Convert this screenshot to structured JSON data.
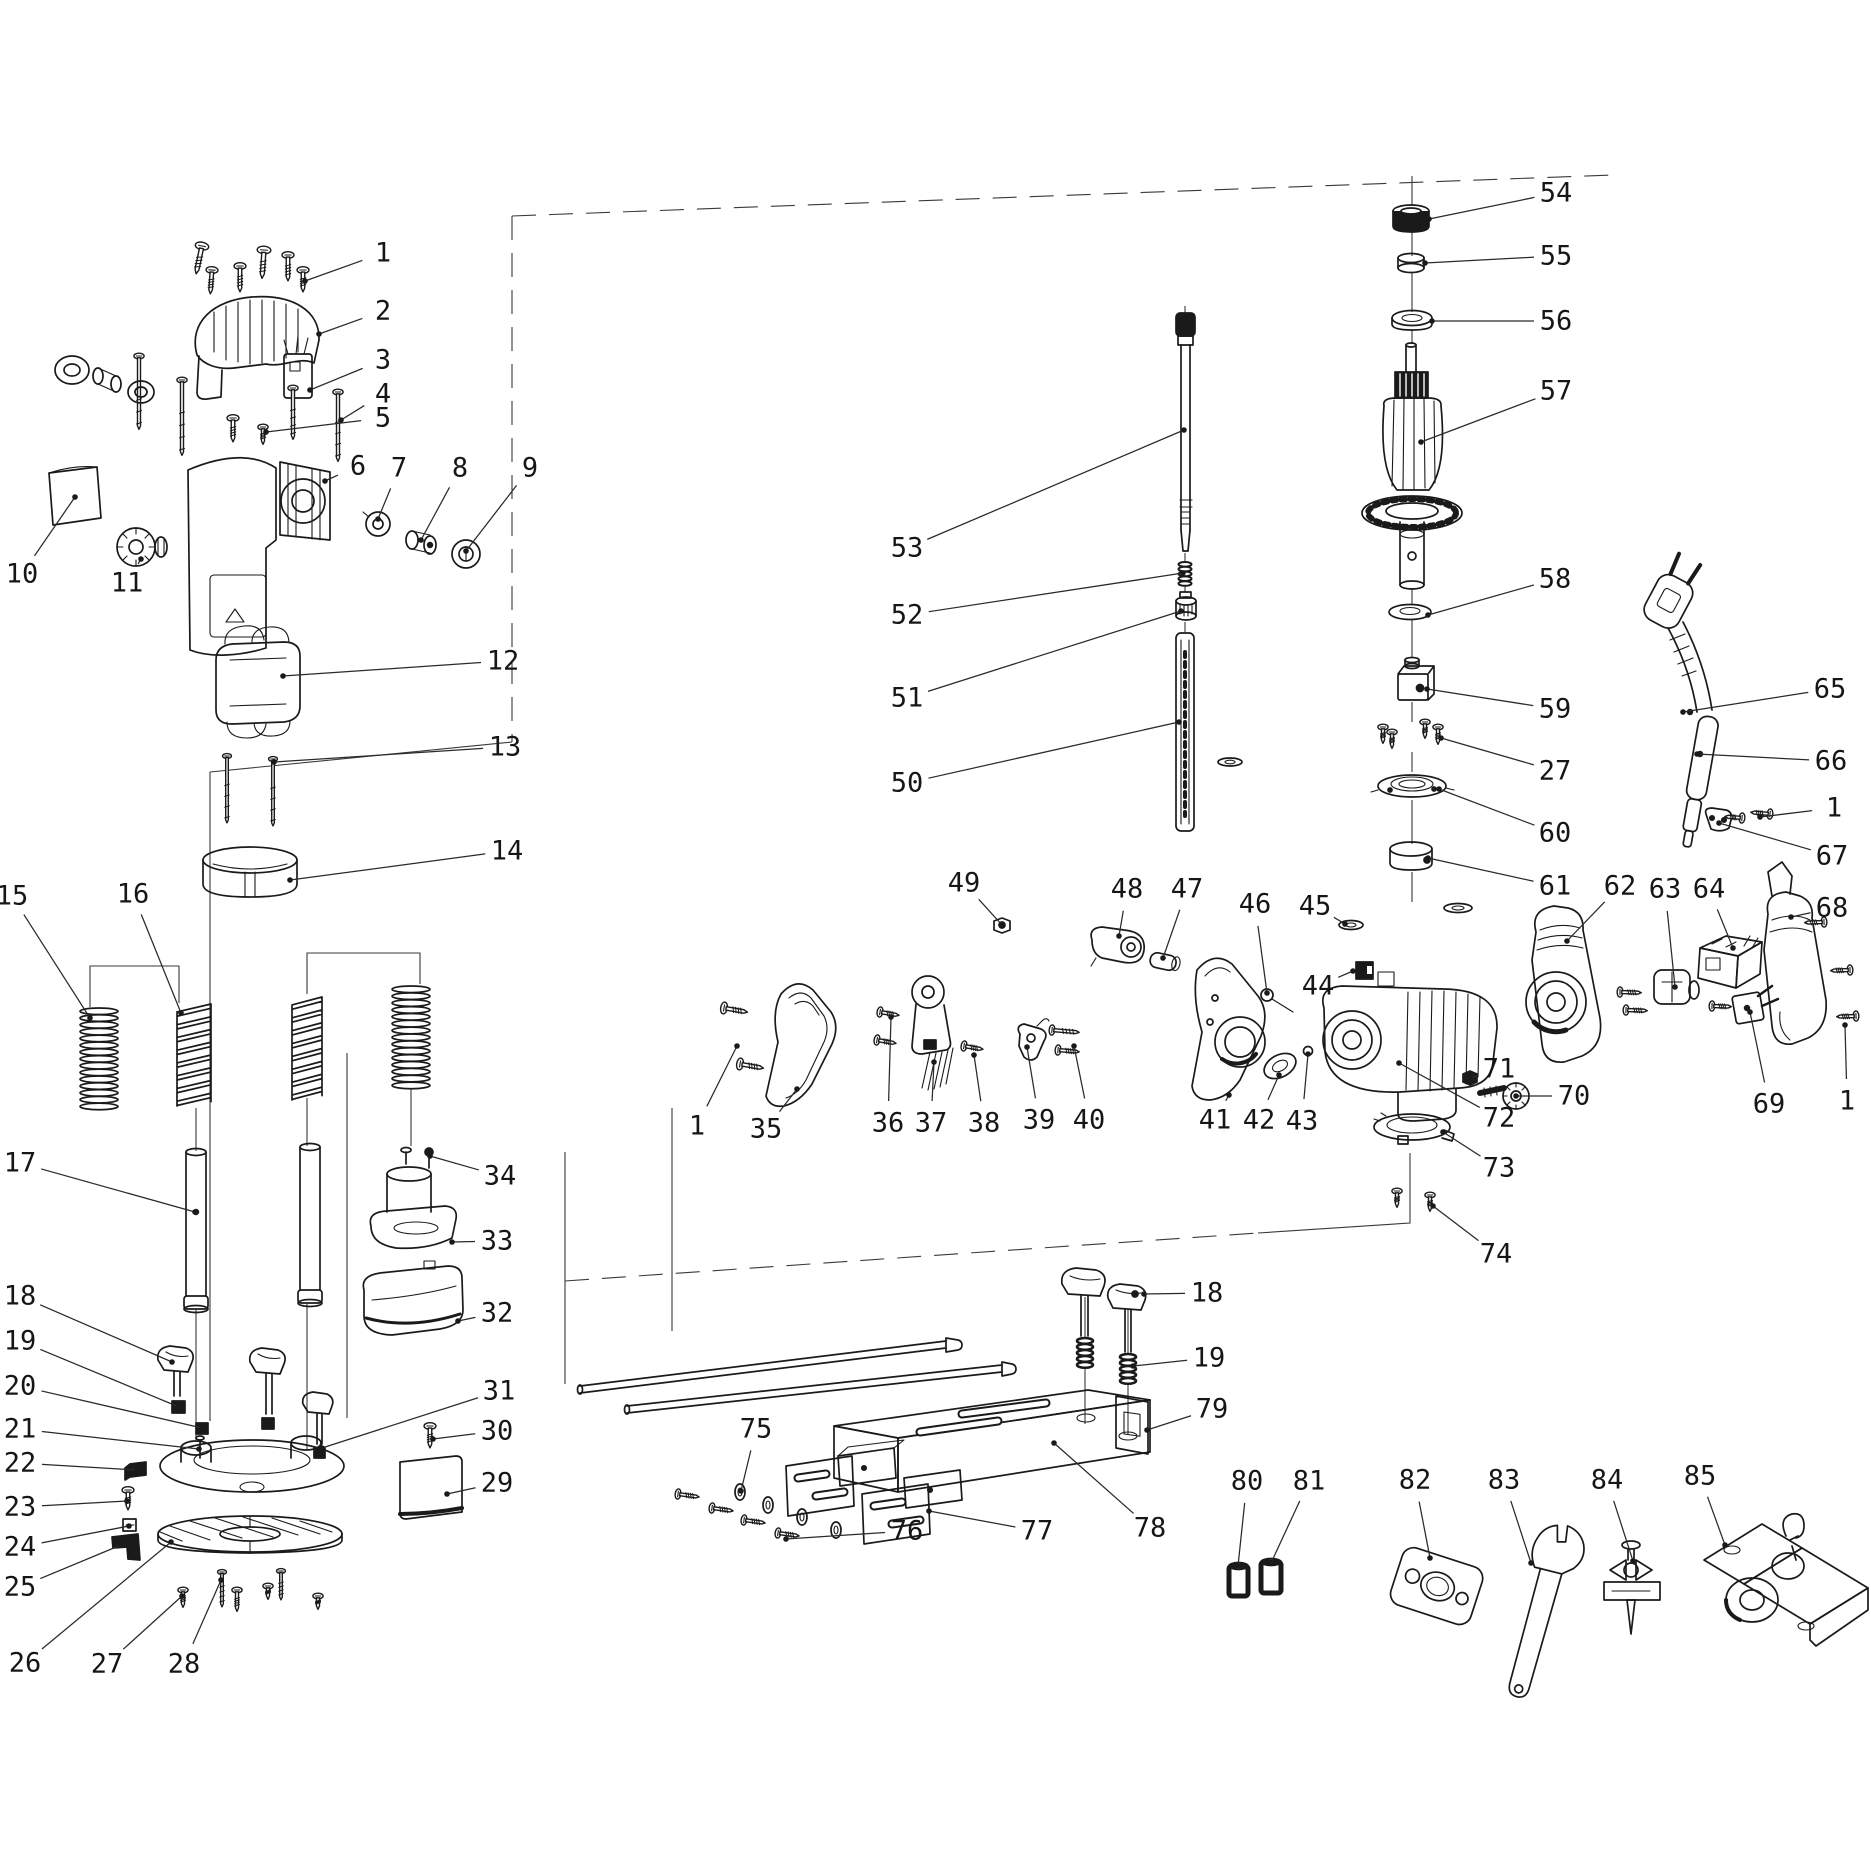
{
  "figure": {
    "kind": "exploded-parts-diagram",
    "background": "#ffffff",
    "ink_color": "#1a1a1a",
    "canvas": {
      "width": 1871,
      "height": 1872
    },
    "part_numbers_visible": [
      "1",
      "2",
      "3",
      "4",
      "5",
      "6",
      "7",
      "8",
      "9",
      "10",
      "11",
      "12",
      "13",
      "14",
      "15",
      "16",
      "17",
      "18",
      "19",
      "20",
      "21",
      "22",
      "23",
      "24",
      "25",
      "26",
      "27",
      "28",
      "29",
      "30",
      "31",
      "32",
      "33",
      "34",
      "35",
      "36",
      "37",
      "38",
      "39",
      "40",
      "41",
      "42",
      "43",
      "44",
      "45",
      "46",
      "47",
      "48",
      "49",
      "50",
      "51",
      "52",
      "53",
      "54",
      "55",
      "56",
      "57",
      "58",
      "59",
      "60",
      "61",
      "62",
      "63",
      "64",
      "65",
      "66",
      "67",
      "68",
      "69",
      "70",
      "71",
      "72",
      "73",
      "74",
      "75",
      "76",
      "77",
      "78",
      "79",
      "80",
      "81",
      "82",
      "83",
      "84",
      "85"
    ]
  },
  "diagram": {
    "leader_dot_radius": 2.8,
    "labels": [
      {
        "n": "1",
        "x": 383,
        "y": 253,
        "tx": 305,
        "ty": 281
      },
      {
        "n": "2",
        "x": 383,
        "y": 311,
        "tx": 319,
        "ty": 334
      },
      {
        "n": "3",
        "x": 383,
        "y": 360,
        "tx": 310,
        "ty": 390
      },
      {
        "n": "4",
        "x": 383,
        "y": 394,
        "tx": 341,
        "ty": 420
      },
      {
        "n": "5",
        "x": 383,
        "y": 418,
        "tx": 266,
        "ty": 432
      },
      {
        "n": "6",
        "x": 358,
        "y": 466,
        "tx": 325,
        "ty": 481
      },
      {
        "n": "7",
        "x": 399,
        "y": 468,
        "tx": 378,
        "ty": 519
      },
      {
        "n": "8",
        "x": 460,
        "y": 468,
        "tx": 421,
        "ty": 540
      },
      {
        "n": "9",
        "x": 530,
        "y": 468,
        "tx": 466,
        "ty": 551
      },
      {
        "n": "10",
        "x": 22,
        "y": 574,
        "tx": 75,
        "ty": 497
      },
      {
        "n": "11",
        "x": 127,
        "y": 583,
        "tx": 141,
        "ty": 559
      },
      {
        "n": "12",
        "x": 503,
        "y": 661,
        "tx": 283,
        "ty": 676
      },
      {
        "n": "13",
        "x": 505,
        "y": 747,
        "tx": 274,
        "ty": 762
      },
      {
        "n": "14",
        "x": 507,
        "y": 851,
        "tx": 290,
        "ty": 880
      },
      {
        "n": "15",
        "x": 12,
        "y": 896,
        "tx": 90,
        "ty": 1018
      },
      {
        "n": "16",
        "x": 133,
        "y": 894,
        "tx": 181,
        "ty": 1013
      },
      {
        "n": "17",
        "x": 20,
        "y": 1163,
        "tx": 195,
        "ty": 1212
      },
      {
        "n": "18",
        "x": 20,
        "y": 1296,
        "tx": 172,
        "ty": 1362
      },
      {
        "n": "19",
        "x": 20,
        "y": 1341,
        "tx": 179,
        "ty": 1407
      },
      {
        "n": "20",
        "x": 20,
        "y": 1386,
        "tx": 202,
        "ty": 1428
      },
      {
        "n": "21",
        "x": 20,
        "y": 1429,
        "tx": 199,
        "ty": 1449
      },
      {
        "n": "22",
        "x": 20,
        "y": 1463,
        "tx": 137,
        "ty": 1470
      },
      {
        "n": "23",
        "x": 20,
        "y": 1507,
        "tx": 127,
        "ty": 1501
      },
      {
        "n": "24",
        "x": 20,
        "y": 1547,
        "tx": 129,
        "ty": 1526
      },
      {
        "n": "25",
        "x": 20,
        "y": 1587,
        "tx": 121,
        "ty": 1545
      },
      {
        "n": "26",
        "x": 25,
        "y": 1663,
        "tx": 171,
        "ty": 1542
      },
      {
        "n": "27",
        "x": 107,
        "y": 1664,
        "tx": 182,
        "ty": 1596
      },
      {
        "n": "28",
        "x": 184,
        "y": 1664,
        "tx": 221,
        "ty": 1580
      },
      {
        "n": "29",
        "x": 497,
        "y": 1483,
        "tx": 447,
        "ty": 1494
      },
      {
        "n": "30",
        "x": 497,
        "y": 1431,
        "tx": 433,
        "ty": 1439
      },
      {
        "n": "31",
        "x": 499,
        "y": 1391,
        "tx": 322,
        "ty": 1448
      },
      {
        "n": "32",
        "x": 497,
        "y": 1313,
        "tx": 458,
        "ty": 1321
      },
      {
        "n": "33",
        "x": 497,
        "y": 1241,
        "tx": 452,
        "ty": 1242
      },
      {
        "n": "34",
        "x": 500,
        "y": 1176,
        "tx": 430,
        "ty": 1156
      },
      {
        "n": "1",
        "x": 697,
        "y": 1126,
        "tx": 737,
        "ty": 1046
      },
      {
        "n": "35",
        "x": 766,
        "y": 1129,
        "tx": 797,
        "ty": 1089
      },
      {
        "n": "36",
        "x": 888,
        "y": 1123,
        "tx": 891,
        "ty": 1017
      },
      {
        "n": "37",
        "x": 931,
        "y": 1123,
        "tx": 934,
        "ty": 1062
      },
      {
        "n": "38",
        "x": 984,
        "y": 1123,
        "tx": 974,
        "ty": 1055
      },
      {
        "n": "39",
        "x": 1039,
        "y": 1120,
        "tx": 1027,
        "ty": 1047
      },
      {
        "n": "40",
        "x": 1089,
        "y": 1120,
        "tx": 1074,
        "ty": 1046
      },
      {
        "n": "41",
        "x": 1215,
        "y": 1120,
        "tx": 1229,
        "ty": 1095
      },
      {
        "n": "42",
        "x": 1259,
        "y": 1120,
        "tx": 1279,
        "ty": 1075
      },
      {
        "n": "43",
        "x": 1302,
        "y": 1121,
        "tx": 1308,
        "ty": 1054
      },
      {
        "n": "44",
        "x": 1318,
        "y": 986,
        "tx": 1353,
        "ty": 971
      },
      {
        "n": "45",
        "x": 1315,
        "y": 906,
        "tx": 1345,
        "ty": 924
      },
      {
        "n": "46",
        "x": 1255,
        "y": 904,
        "tx": 1267,
        "ty": 993
      },
      {
        "n": "47",
        "x": 1187,
        "y": 889,
        "tx": 1163,
        "ty": 958
      },
      {
        "n": "48",
        "x": 1127,
        "y": 889,
        "tx": 1119,
        "ty": 936
      },
      {
        "n": "49",
        "x": 964,
        "y": 883,
        "tx": 1002,
        "ty": 925
      },
      {
        "n": "50",
        "x": 907,
        "y": 783,
        "tx": 1179,
        "ty": 722
      },
      {
        "n": "51",
        "x": 907,
        "y": 698,
        "tx": 1181,
        "ty": 611
      },
      {
        "n": "52",
        "x": 907,
        "y": 615,
        "tx": 1183,
        "ty": 573
      },
      {
        "n": "53",
        "x": 907,
        "y": 548,
        "tx": 1184,
        "ty": 430
      },
      {
        "n": "54",
        "x": 1556,
        "y": 193,
        "tx": 1429,
        "ty": 219
      },
      {
        "n": "55",
        "x": 1556,
        "y": 256,
        "tx": 1425,
        "ty": 263
      },
      {
        "n": "56",
        "x": 1556,
        "y": 321,
        "tx": 1432,
        "ty": 321
      },
      {
        "n": "57",
        "x": 1556,
        "y": 391,
        "tx": 1421,
        "ty": 442
      },
      {
        "n": "58",
        "x": 1555,
        "y": 579,
        "tx": 1428,
        "ty": 615
      },
      {
        "n": "59",
        "x": 1555,
        "y": 709,
        "tx": 1427,
        "ty": 689
      },
      {
        "n": "27",
        "x": 1555,
        "y": 771,
        "tx": 1441,
        "ty": 738
      },
      {
        "n": "60",
        "x": 1555,
        "y": 833,
        "tx": 1439,
        "ty": 789
      },
      {
        "n": "61",
        "x": 1555,
        "y": 886,
        "tx": 1428,
        "ty": 858
      },
      {
        "n": "62",
        "x": 1620,
        "y": 886,
        "tx": 1567,
        "ty": 941
      },
      {
        "n": "63",
        "x": 1665,
        "y": 889,
        "tx": 1675,
        "ty": 987
      },
      {
        "n": "64",
        "x": 1709,
        "y": 889,
        "tx": 1733,
        "ty": 948
      },
      {
        "n": "65",
        "x": 1830,
        "y": 689,
        "tx": 1683,
        "ty": 712
      },
      {
        "n": "66",
        "x": 1831,
        "y": 761,
        "tx": 1697,
        "ty": 754
      },
      {
        "n": "1",
        "x": 1834,
        "y": 808,
        "tx": 1760,
        "ty": 817
      },
      {
        "n": "67",
        "x": 1832,
        "y": 856,
        "tx": 1719,
        "ty": 823
      },
      {
        "n": "68",
        "x": 1832,
        "y": 908,
        "tx": 1791,
        "ty": 917
      },
      {
        "n": "69",
        "x": 1769,
        "y": 1104,
        "tx": 1750,
        "ty": 1012
      },
      {
        "n": "1",
        "x": 1847,
        "y": 1101,
        "tx": 1845,
        "ty": 1025
      },
      {
        "n": "70",
        "x": 1574,
        "y": 1096,
        "tx": 1516,
        "ty": 1096
      },
      {
        "n": "71",
        "x": 1499,
        "y": 1069,
        "tx": 1470,
        "ty": 1078
      },
      {
        "n": "72",
        "x": 1499,
        "y": 1118,
        "tx": 1399,
        "ty": 1063
      },
      {
        "n": "73",
        "x": 1499,
        "y": 1168,
        "tx": 1443,
        "ty": 1132
      },
      {
        "n": "74",
        "x": 1496,
        "y": 1254,
        "tx": 1433,
        "ty": 1206
      },
      {
        "n": "18",
        "x": 1207,
        "y": 1293,
        "tx": 1144,
        "ty": 1294
      },
      {
        "n": "19",
        "x": 1209,
        "y": 1358,
        "tx": 1133,
        "ty": 1366
      },
      {
        "n": "75",
        "x": 756,
        "y": 1429,
        "tx": 741,
        "ty": 1491
      },
      {
        "n": "76",
        "x": 907,
        "y": 1531,
        "tx": 786,
        "ty": 1539
      },
      {
        "n": "77",
        "x": 1037,
        "y": 1531,
        "tx": 929,
        "ty": 1511
      },
      {
        "n": "78",
        "x": 1150,
        "y": 1528,
        "tx": 1054,
        "ty": 1443
      },
      {
        "n": "79",
        "x": 1212,
        "y": 1409,
        "tx": 1147,
        "ty": 1430
      },
      {
        "n": "80",
        "x": 1247,
        "y": 1481,
        "tx": 1238,
        "ty": 1566
      },
      {
        "n": "81",
        "x": 1309,
        "y": 1481,
        "tx": 1271,
        "ty": 1563
      },
      {
        "n": "82",
        "x": 1415,
        "y": 1480,
        "tx": 1430,
        "ty": 1558
      },
      {
        "n": "83",
        "x": 1504,
        "y": 1480,
        "tx": 1531,
        "ty": 1563
      },
      {
        "n": "84",
        "x": 1607,
        "y": 1480,
        "tx": 1633,
        "ty": 1561
      },
      {
        "n": "85",
        "x": 1700,
        "y": 1476,
        "tx": 1725,
        "ty": 1545
      }
    ]
  }
}
